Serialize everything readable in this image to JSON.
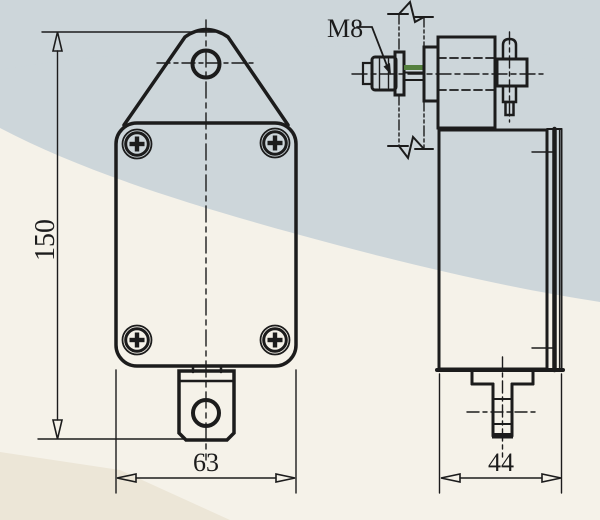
{
  "drawing": {
    "type": "engineering-drawing-two-views-limit-switch",
    "views": {
      "front": "front-view",
      "side": "side-view"
    },
    "dimensions": {
      "height": "150",
      "front_width": "63",
      "side_depth": "44"
    },
    "annotations": {
      "thread_label": "M8"
    },
    "colors": {
      "line": "#1c1c1c",
      "paper": "#f5f2e9",
      "paper_shade": "#cdd6da",
      "paper_shade_dark": "#ece6d7",
      "thread_highlight": "#55803f"
    }
  }
}
